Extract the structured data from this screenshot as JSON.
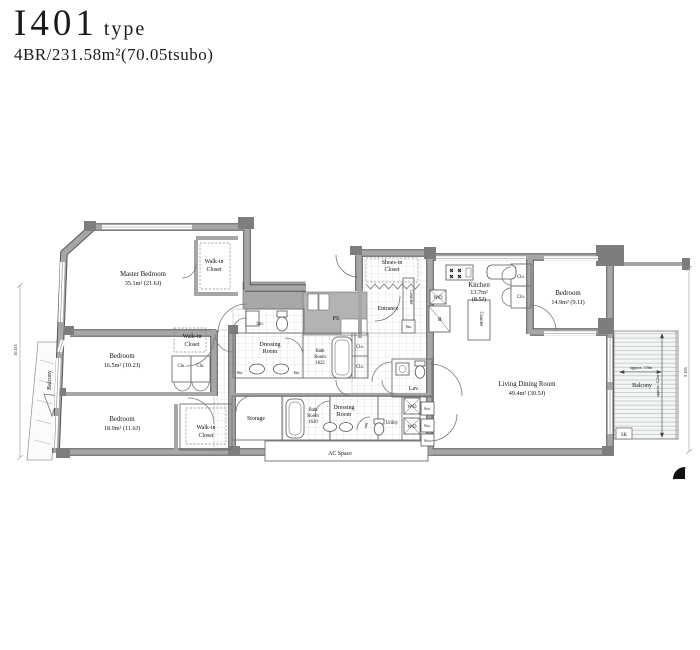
{
  "title": {
    "unit": "I401",
    "suffix": "type",
    "spec": "4BR/231.58m²(70.05tsubo)"
  },
  "rooms": {
    "master_bedroom": {
      "name": "Master Bedroom",
      "area": "35.1m²  (21.6J)"
    },
    "bedroom_2": {
      "name": "Bedroom",
      "area": "16.5m²  (10.2J)"
    },
    "bedroom_3": {
      "name": "Bedroom",
      "area": "18.9m²  (11.6J)"
    },
    "bedroom_4": {
      "name": "Bedroom",
      "area": "14.9m²  (9.1J)"
    },
    "living_dining": {
      "name": "Living Dining Room",
      "area": "49.4m²  (30.5J)"
    },
    "kitchen": {
      "name": "Kitchen",
      "area1": "13.7m²",
      "area2": "(8.5J)"
    },
    "entrance": {
      "name": "Entrance"
    },
    "storage": {
      "name": "Storage"
    },
    "lav": {
      "name": "Lav."
    },
    "utility": {
      "name": "Utility"
    },
    "ps": {
      "name": "PS"
    },
    "ac_space": {
      "name": "AC Space"
    },
    "balcony": {
      "name": "Balcony"
    }
  },
  "labels": {
    "wic": {
      "l1": "Walk-in",
      "l2": "Closet"
    },
    "shoes": {
      "l1": "Shoes-in",
      "l2": "Closet"
    },
    "dressing": {
      "l1": "Dressing",
      "l2": "Room"
    },
    "bath_1822": {
      "l1": "Bath",
      "l2": "Room",
      "l3": "1822"
    },
    "bath_1620": {
      "l1": "Bath",
      "l2": "Room",
      "l3": "1620"
    },
    "sto": "Sto.",
    "clo": "Clo.",
    "wd": "W/D",
    "r": "R",
    "counter": "Counter",
    "sk": "SK"
  },
  "dimensions": {
    "balcony_w": "approx. 3.9m",
    "balcony_h": "approx. 4.2m",
    "left_edge": "10.435",
    "right_edge": "9.185"
  },
  "colors": {
    "wall": "#a6a6a6",
    "wall_dark": "#828282",
    "line": "#555555",
    "tile": "#ccd4da"
  }
}
